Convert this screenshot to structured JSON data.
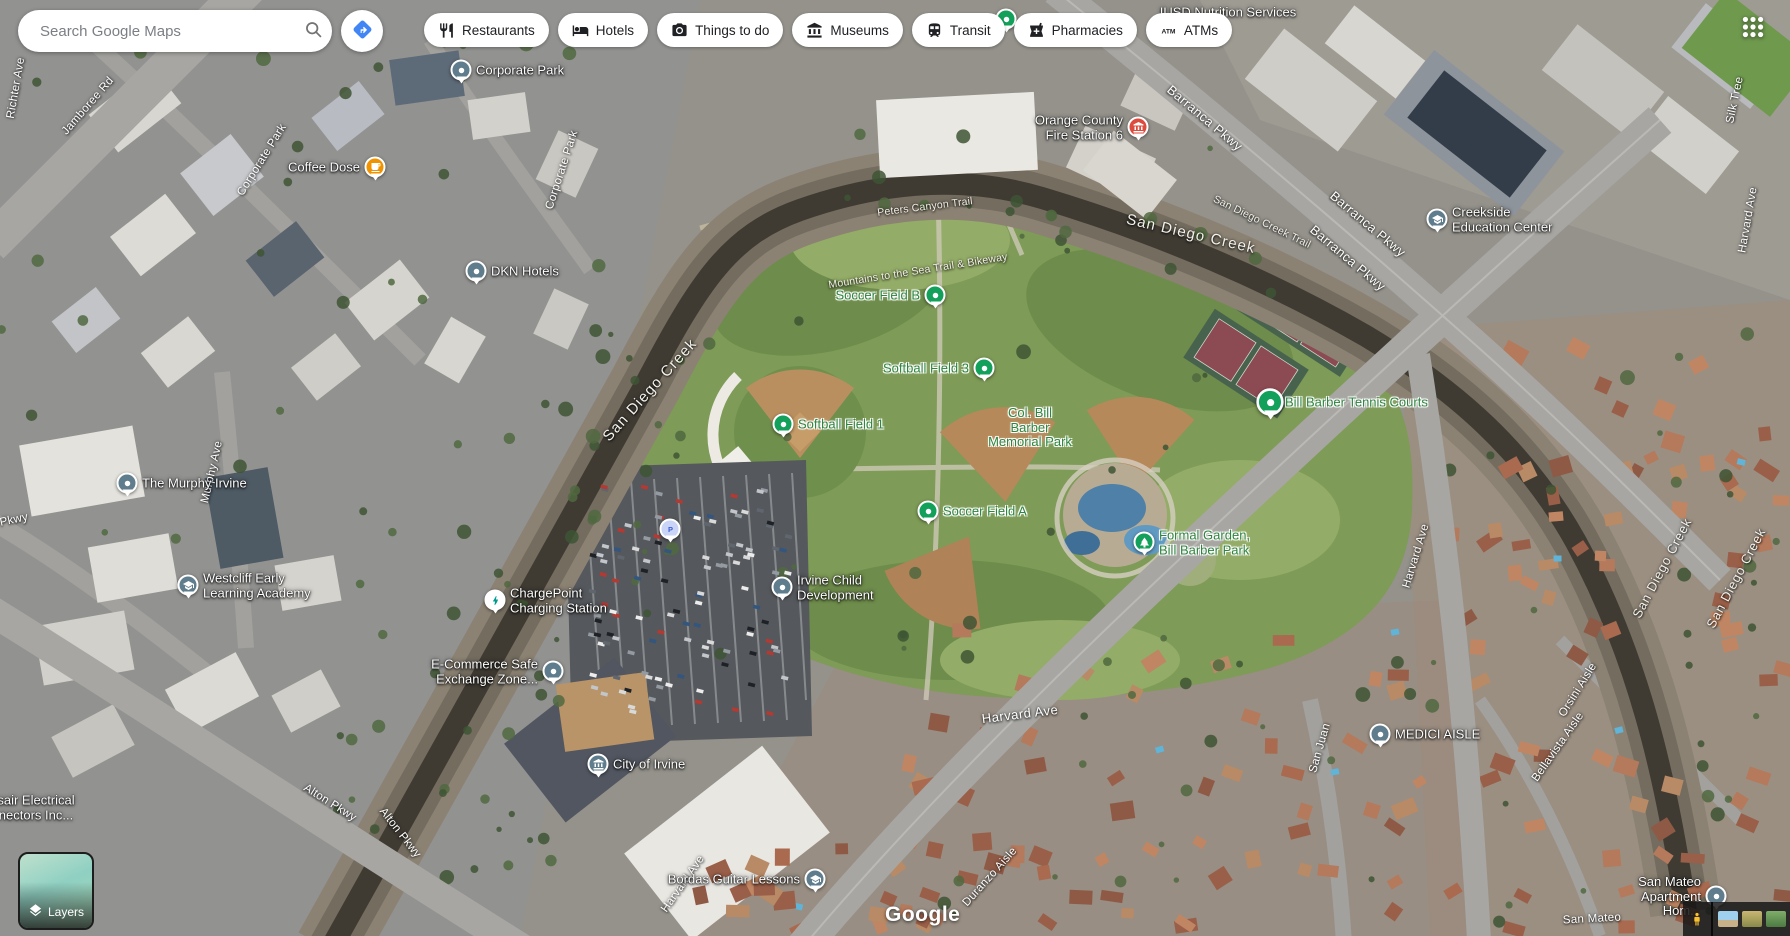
{
  "app": {
    "search_placeholder": "Search Google Maps",
    "logo_text": "Google"
  },
  "top_bar": {
    "categories": [
      {
        "label": "Restaurants",
        "icon": "restaurants-icon"
      },
      {
        "label": "Hotels",
        "icon": "hotels-icon"
      },
      {
        "label": "Things to do",
        "icon": "things-to-do-icon"
      },
      {
        "label": "Museums",
        "icon": "museums-icon"
      },
      {
        "label": "Transit",
        "icon": "transit-icon"
      },
      {
        "label": "Pharmacies",
        "icon": "pharmacies-icon"
      },
      {
        "label": "ATMs",
        "icon": "atms-icon"
      }
    ]
  },
  "map": {
    "pois": [
      {
        "id": "corporate-park",
        "label": "Corporate Park",
        "x": 461,
        "y": 71,
        "pin": "slate-dot",
        "side": "right",
        "text": "white"
      },
      {
        "id": "coffee-dose",
        "label": "Coffee Dose",
        "x": 375,
        "y": 168,
        "pin": "orange-coffee",
        "side": "left",
        "text": "white"
      },
      {
        "id": "dkn-hotels",
        "label": "DKN Hotels",
        "x": 476,
        "y": 272,
        "pin": "slate-dot",
        "side": "right",
        "text": "white"
      },
      {
        "id": "orange-county-fire-station-6",
        "label": "Orange County\nFire Station 6",
        "x": 1138,
        "y": 128,
        "pin": "red-civic",
        "side": "left",
        "text": "white"
      },
      {
        "id": "iusd-nutrition-services",
        "label": "IUSD Nutrition Services",
        "x": 1228,
        "y": 13,
        "pin": "none",
        "side": "center",
        "text": "white"
      },
      {
        "id": "creekside-education-center",
        "label": "Creekside\nEducation Center",
        "x": 1437,
        "y": 220,
        "pin": "slate-school",
        "side": "right",
        "text": "white"
      },
      {
        "id": "the-murphy-irvine",
        "label": "The Murphy Irvine",
        "x": 127,
        "y": 484,
        "pin": "slate-dot",
        "side": "right",
        "text": "white"
      },
      {
        "id": "westcliff-early-learning-academy",
        "label": "Westcliff Early\nLearning Academy",
        "x": 188,
        "y": 586,
        "pin": "slate-school",
        "side": "right",
        "text": "white"
      },
      {
        "id": "chargepoint-charging-station",
        "label": "ChargePoint\nCharging Station",
        "x": 495,
        "y": 601,
        "pin": "white-bolt",
        "side": "right",
        "text": "white"
      },
      {
        "id": "e-commerce-safe-exchange-zone",
        "label": "E-Commerce Safe\nExchange Zone...",
        "x": 553,
        "y": 672,
        "pin": "slate-dot",
        "side": "left",
        "text": "white"
      },
      {
        "id": "parking",
        "label": "",
        "x": 670,
        "y": 530,
        "pin": "parking",
        "side": "right",
        "text": "white"
      },
      {
        "id": "irvine-child-development",
        "label": "Irvine Child\nDevelopment",
        "x": 782,
        "y": 588,
        "pin": "slate-dot",
        "side": "right",
        "text": "white"
      },
      {
        "id": "city-of-irvine",
        "label": "City of Irvine",
        "x": 598,
        "y": 765,
        "pin": "slate-civic",
        "side": "right",
        "text": "white"
      },
      {
        "id": "bordas-guitar-lessons",
        "label": "Bordas Guitar Lessons",
        "x": 815,
        "y": 880,
        "pin": "slate-school",
        "side": "left",
        "text": "white"
      },
      {
        "id": "medici-aisle",
        "label": "MEDICI AISLE",
        "x": 1380,
        "y": 735,
        "pin": "slate-dot",
        "side": "right",
        "text": "white"
      },
      {
        "id": "san-mateo-apartment",
        "label": "San Mateo\nApartment Hom...",
        "x": 1716,
        "y": 897,
        "pin": "slate-dot",
        "side": "left",
        "text": "white"
      },
      {
        "id": "electrical-connectors",
        "label": "sair Electrical\nnectors Inc...",
        "x": 36,
        "y": 808,
        "pin": "none",
        "side": "center",
        "text": "white"
      },
      {
        "id": "soccer-field-b",
        "label": "Soccer Field B",
        "x": 935,
        "y": 296,
        "pin": "green-dot",
        "side": "left",
        "text": "green"
      },
      {
        "id": "softball-field-3",
        "label": "Softball Field 3",
        "x": 984,
        "y": 369,
        "pin": "green-dot",
        "side": "left",
        "text": "green"
      },
      {
        "id": "softball-field-1",
        "label": "Softball Field 1",
        "x": 783,
        "y": 425,
        "pin": "green-dot",
        "side": "right",
        "text": "green"
      },
      {
        "id": "bill-barber-tennis-courts",
        "label": "Bill Barber Tennis Courts",
        "x": 1270,
        "y": 403,
        "pin": "green-dot-lg",
        "side": "right",
        "text": "green"
      },
      {
        "id": "soccer-field-a",
        "label": "Soccer Field A",
        "x": 928,
        "y": 512,
        "pin": "green-dot",
        "side": "right",
        "text": "green"
      },
      {
        "id": "formal-garden-bill-barber-park",
        "label": "Formal Garden,\nBill Barber Park",
        "x": 1144,
        "y": 543,
        "pin": "green-tree",
        "side": "right",
        "text": "green"
      },
      {
        "id": "col-bill-barber-memorial-park",
        "label": "Col. Bill\nBarber\nMemorial Park",
        "x": 1030,
        "y": 428,
        "pin": "none",
        "side": "center",
        "text": "green"
      },
      {
        "id": "partially-hidden-poi",
        "label": "",
        "x": 1006,
        "y": 20,
        "pin": "green-dot",
        "side": "right",
        "text": "green"
      }
    ],
    "street_labels": [
      {
        "text": "Richter Ave",
        "x": 16,
        "y": 88,
        "rot": -80,
        "kind": "street"
      },
      {
        "text": "Jamboree Rd",
        "x": 88,
        "y": 106,
        "rot": -49,
        "kind": "street"
      },
      {
        "text": "Corporate Park",
        "x": 262,
        "y": 160,
        "rot": -58,
        "kind": "street"
      },
      {
        "text": "Corporate Park",
        "x": 562,
        "y": 170,
        "rot": -72,
        "kind": "street"
      },
      {
        "text": "Murphy Ave",
        "x": 212,
        "y": 472,
        "rot": -77,
        "kind": "street"
      },
      {
        "text": "Pkwy",
        "x": 14,
        "y": 520,
        "rot": -12,
        "kind": "street"
      },
      {
        "text": "Alton Pkwy",
        "x": 330,
        "y": 803,
        "rot": 32,
        "kind": "street"
      },
      {
        "text": "Alton Pkwy",
        "x": 400,
        "y": 833,
        "rot": 52,
        "kind": "street"
      },
      {
        "text": "Harvard Ave",
        "x": 683,
        "y": 884,
        "rot": -55,
        "kind": "street"
      },
      {
        "text": "Harvard Ave",
        "x": 1020,
        "y": 714,
        "rot": -7,
        "kind": "street-lg"
      },
      {
        "text": "Harvard Ave",
        "x": 1416,
        "y": 556,
        "rot": -73,
        "kind": "street"
      },
      {
        "text": "Harvard Ave",
        "x": 1748,
        "y": 220,
        "rot": -80,
        "kind": "street"
      },
      {
        "text": "Silk Tree",
        "x": 1735,
        "y": 100,
        "rot": -78,
        "kind": "street"
      },
      {
        "text": "Barranca Pkwy",
        "x": 1205,
        "y": 118,
        "rot": 40,
        "kind": "street-lg"
      },
      {
        "text": "Barranca Pkwy",
        "x": 1368,
        "y": 224,
        "rot": 40,
        "kind": "street-lg"
      },
      {
        "text": "Barranca Pkwy",
        "x": 1348,
        "y": 258,
        "rot": 40,
        "kind": "street-lg"
      },
      {
        "text": "San Diego Creek",
        "x": 650,
        "y": 390,
        "rot": -48,
        "kind": "water"
      },
      {
        "text": "San Diego Creek",
        "x": 1191,
        "y": 234,
        "rot": 13,
        "kind": "water"
      },
      {
        "text": "San Diego Creek Trail",
        "x": 1262,
        "y": 222,
        "rot": 26,
        "kind": "trail"
      },
      {
        "text": "Peters Canyon Trail",
        "x": 925,
        "y": 207,
        "rot": -7,
        "kind": "trail"
      },
      {
        "text": "Mountains to the Sea Trail & Bikeway",
        "x": 918,
        "y": 271,
        "rot": -9,
        "kind": "trail"
      },
      {
        "text": "San Diego Creek",
        "x": 1662,
        "y": 568,
        "rot": -62,
        "kind": "water-sm"
      },
      {
        "text": "San Diego Creek",
        "x": 1736,
        "y": 578,
        "rot": -62,
        "kind": "water-sm"
      },
      {
        "text": "Orsini Aisle",
        "x": 1578,
        "y": 690,
        "rot": -58,
        "kind": "street"
      },
      {
        "text": "Bellavista Aisle",
        "x": 1558,
        "y": 747,
        "rot": -55,
        "kind": "street"
      },
      {
        "text": "San Juan",
        "x": 1320,
        "y": 748,
        "rot": -74,
        "kind": "street"
      },
      {
        "text": "Duranzo Aisle",
        "x": 990,
        "y": 877,
        "rot": -48,
        "kind": "street"
      },
      {
        "text": "San Mateo",
        "x": 1592,
        "y": 919,
        "rot": -3,
        "kind": "street"
      }
    ],
    "controls": {
      "layers_label": "Layers"
    }
  },
  "colors": {
    "pin_slate": "#5f7d8c",
    "pin_green": "#12a05a",
    "pin_orange": "#f09300",
    "pin_red": "#dd4b3e",
    "bolt_teal": "#009b8e",
    "parking_bg": "#c9d4f6",
    "parking_p": "#3c5bd9",
    "label_green": "#2f8540",
    "accent_blue": "#4285f4"
  }
}
